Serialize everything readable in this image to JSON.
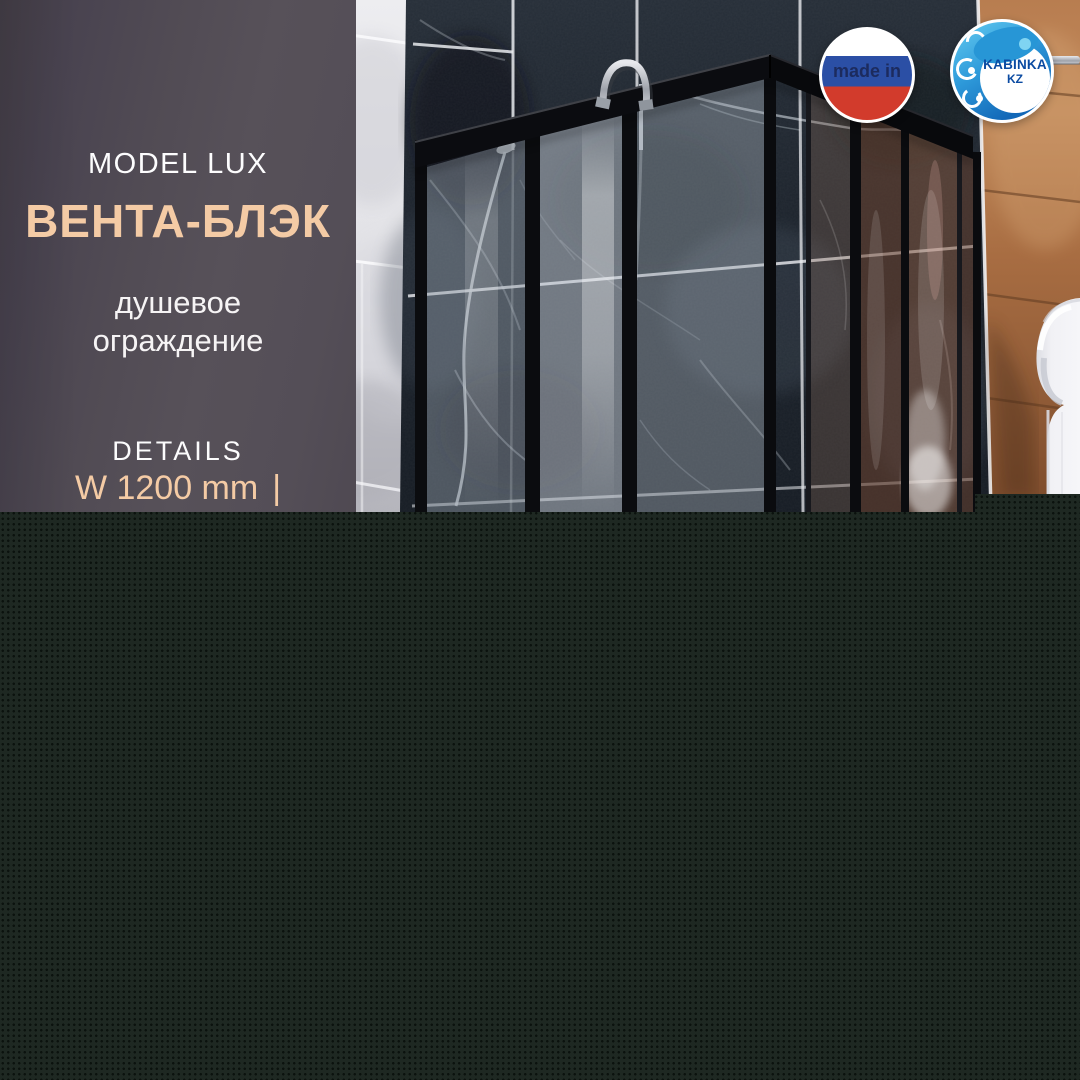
{
  "card": {
    "panel": {
      "model_label": "MODEL LUX",
      "product_name": "ВЕНТА-БЛЭК",
      "subtitle_line1": "душевое",
      "subtitle_line2": "ограждение",
      "details_label": "DETAILS",
      "dimension_width": "W 1200 mm",
      "dimension_separator": "|"
    },
    "badges": {
      "made_in_label": "made in",
      "kabinka_title": "KABINKA",
      "kabinka_region": "KZ"
    },
    "colors": {
      "accent_peach": "#F4CBA5",
      "panel_background": "#524C55",
      "footer_background": "#1E2822",
      "flag_white": "#FFFFFF",
      "flag_blue": "#2B4FA5",
      "flag_red": "#D23B2C",
      "made_in_text": "#1C2B5E",
      "kabinka_blue": "#1268B8",
      "kabinka_light_blue": "#5EC6EE",
      "kabinka_text": "#0B4BA2",
      "frame_black": "#0B0C10"
    }
  }
}
